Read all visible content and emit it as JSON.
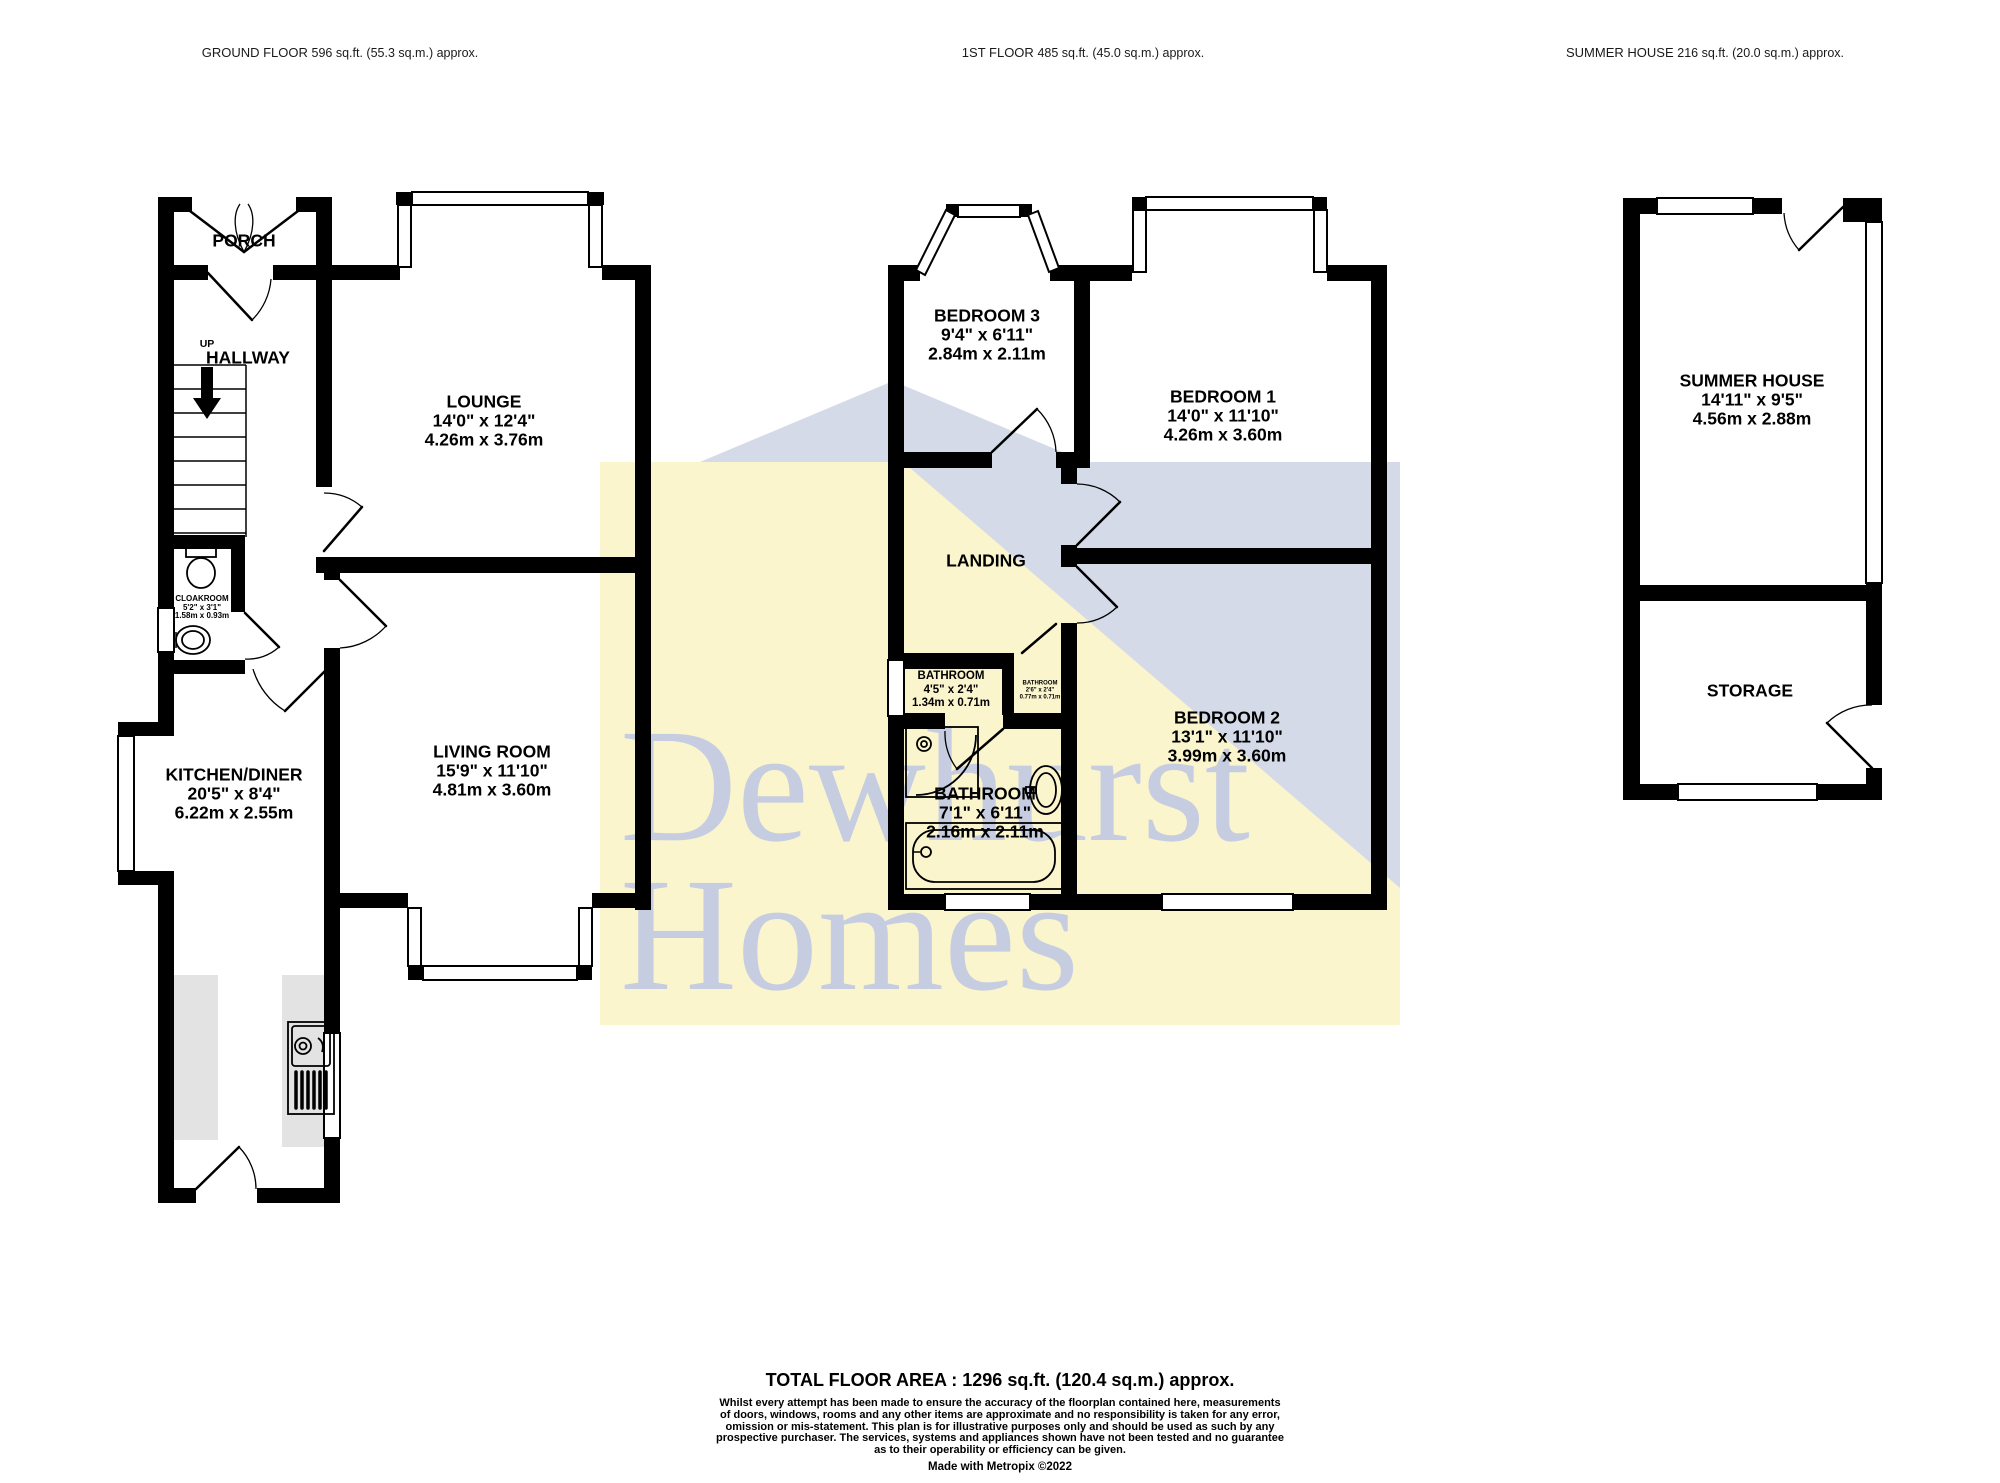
{
  "colors": {
    "wall": "#000000",
    "watermark_yellow": "#FBF5CE",
    "watermark_blue": "#D5DAE8",
    "watermark_text": "#C6CDE1",
    "counter_gray": "#E3E3E3"
  },
  "headers": {
    "ground_floor": {
      "title": "GROUND FLOOR",
      "area": "596 sq.ft. (55.3 sq.m.) approx."
    },
    "first_floor": {
      "title": "1ST FLOOR",
      "area": "485 sq.ft. (45.0 sq.m.) approx."
    },
    "summer_house": {
      "title": "SUMMER HOUSE",
      "area": "216 sq.ft. (20.0 sq.m.) approx."
    }
  },
  "ground_floor": {
    "porch": {
      "name": "PORCH"
    },
    "hallway": {
      "name": "HALLWAY",
      "direction": "UP"
    },
    "cloakroom": {
      "name": "CLOAKROOM",
      "imperial": "5'2\" x 3'1\"",
      "metric": "1.58m x 0.93m"
    },
    "lounge": {
      "name": "LOUNGE",
      "imperial": "14'0\" x 12'4\"",
      "metric": "4.26m x 3.76m"
    },
    "living_room": {
      "name": "LIVING ROOM",
      "imperial": "15'9\" x 11'10\"",
      "metric": "4.81m x 3.60m"
    },
    "kitchen_diner": {
      "name": "KITCHEN/DINER",
      "imperial": "20'5\" x 8'4\"",
      "metric": "6.22m x 2.55m"
    }
  },
  "first_floor": {
    "bedroom3": {
      "name": "BEDROOM 3",
      "imperial": "9'4\" x 6'11\"",
      "metric": "2.84m x 2.11m"
    },
    "bedroom1": {
      "name": "BEDROOM 1",
      "imperial": "14'0\" x 11'10\"",
      "metric": "4.26m x 3.60m"
    },
    "landing": {
      "name": "LANDING"
    },
    "bathroom_small": {
      "name": "BATHROOM",
      "imperial": "4'5\" x 2'4\"",
      "metric": "1.34m x 0.71m"
    },
    "bathroom_tiny": {
      "name": "BATHROOM",
      "imperial": "2'6\" x 2'4\"",
      "metric": "0.77m x 0.71m"
    },
    "bathroom_main": {
      "name": "BATHROOM",
      "imperial": "7'1\" x 6'11\"",
      "metric": "2.16m x 2.11m"
    },
    "bedroom2": {
      "name": "BEDROOM 2",
      "imperial": "13'1\" x 11'10\"",
      "metric": "3.99m x 3.60m"
    }
  },
  "summer_house_plan": {
    "summer_house": {
      "name": "SUMMER HOUSE",
      "imperial": "14'11\" x 9'5\"",
      "metric": "4.56m x 2.88m"
    },
    "storage": {
      "name": "STORAGE"
    }
  },
  "watermark": {
    "line1": "Dewhurst",
    "line2": "Homes"
  },
  "footer": {
    "total": "TOTAL FLOOR AREA : 1296 sq.ft. (120.4 sq.m.) approx.",
    "disclaimer": "Whilst every attempt has been made to ensure the accuracy of the floorplan contained here, measurements\nof doors, windows, rooms and any other items are approximate and no responsibility is taken for any error,\nomission or mis-statement. This plan is for illustrative purposes only and should be used as such by any\nprospective purchaser. The services, systems and appliances shown have not been tested and no guarantee\nas to their operability or efficiency can be given.",
    "credit": "Made with Metropix ©2022"
  }
}
